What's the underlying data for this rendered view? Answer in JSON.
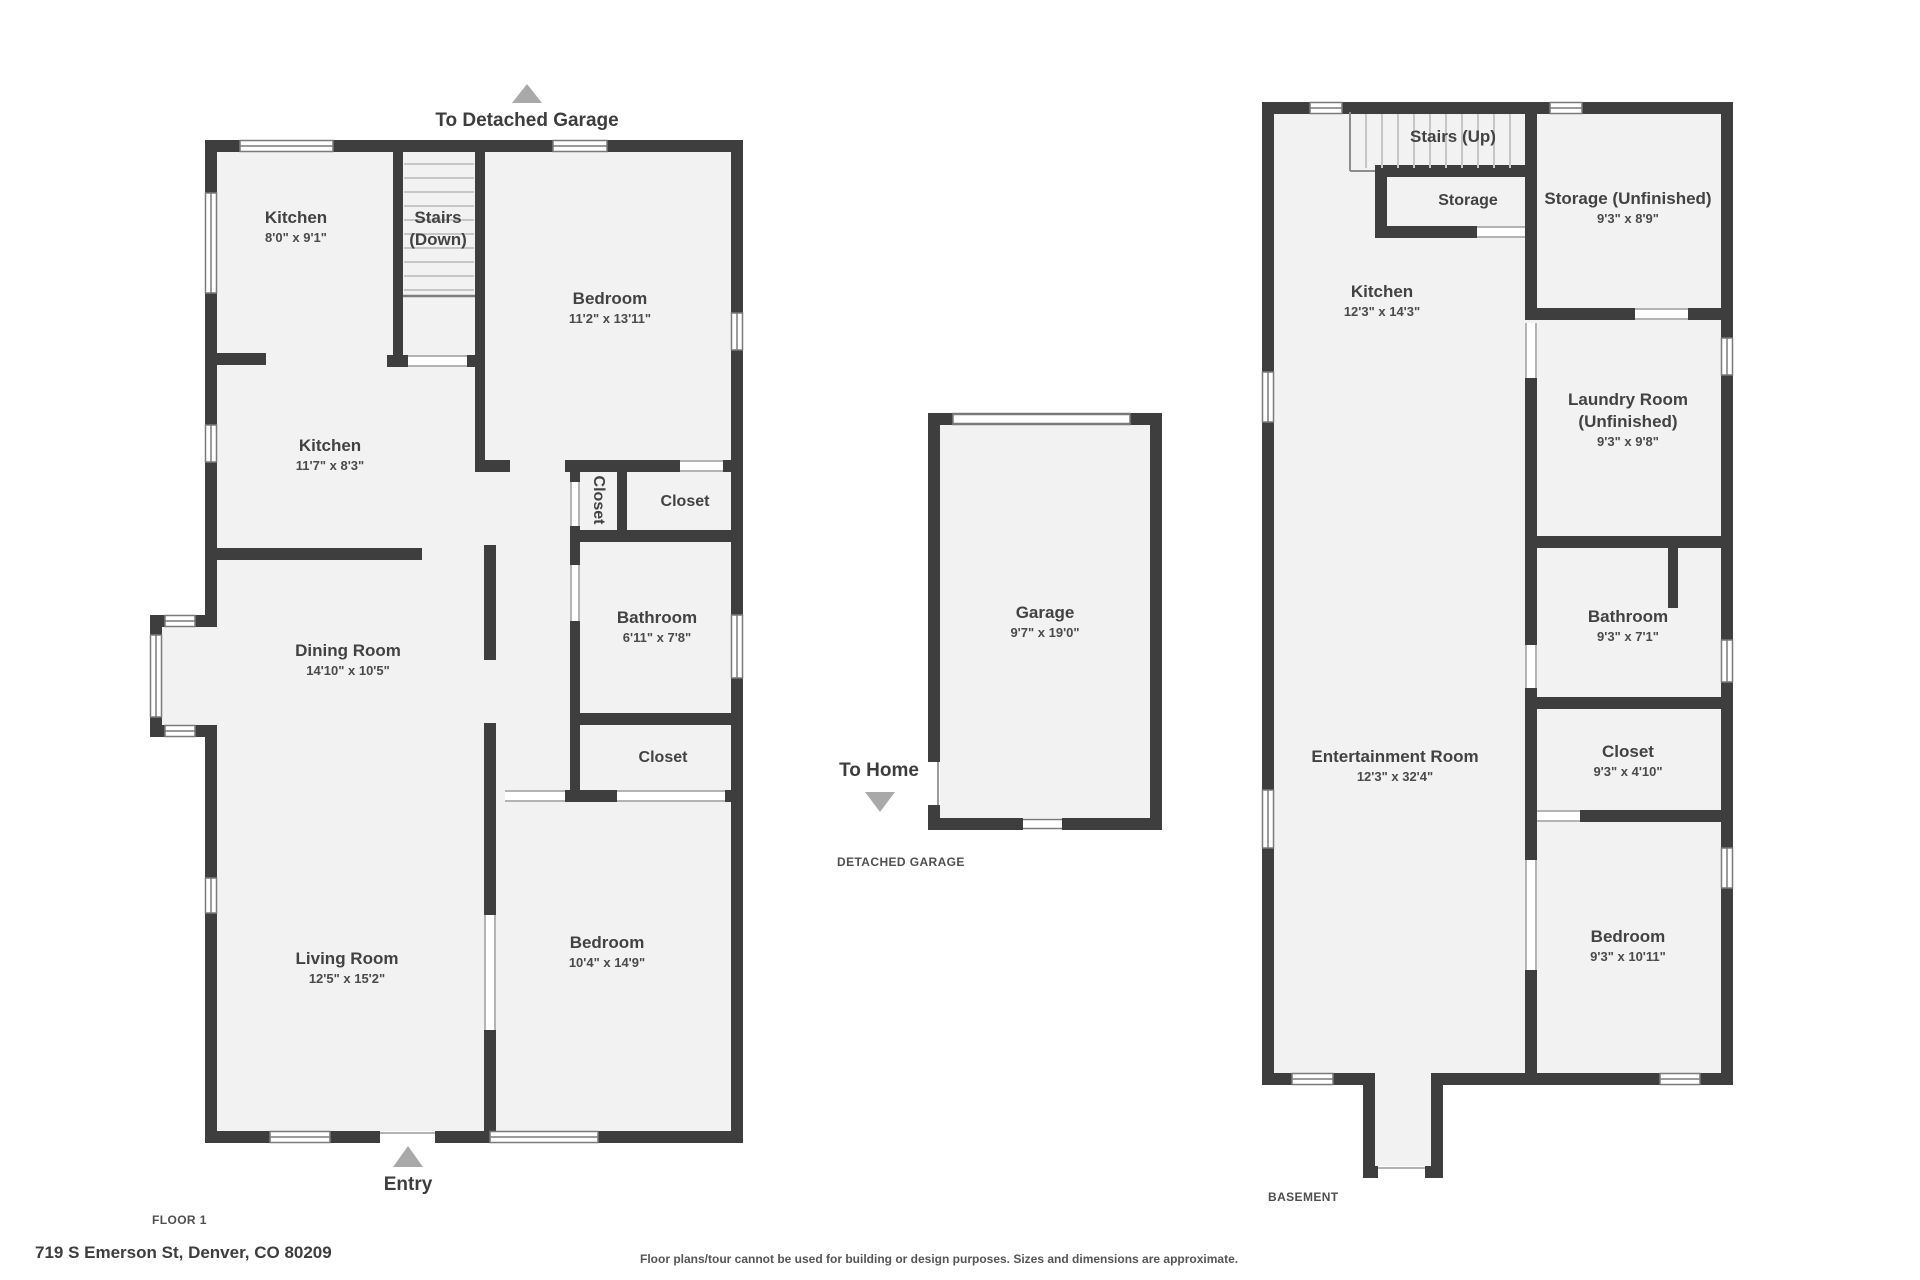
{
  "floor1": {
    "section_label": "FLOOR 1",
    "to_detached_garage_label": "To Detached Garage",
    "entry_label": "Entry",
    "rooms": {
      "kitchen_upper": {
        "name": "Kitchen",
        "dims": "8'0\" x 9'1\""
      },
      "stairs_down": {
        "line1": "Stairs",
        "line2": "(Down)"
      },
      "bedroom_upper": {
        "name": "Bedroom",
        "dims": "11'2\" x 13'11\""
      },
      "kitchen_lower": {
        "name": "Kitchen",
        "dims": "11'7\" x 8'3\""
      },
      "closet_vertical": {
        "name": "Closet"
      },
      "closet_upper": {
        "name": "Closet"
      },
      "bathroom": {
        "name": "Bathroom",
        "dims": "6'11\" x 7'8\""
      },
      "dining_room": {
        "name": "Dining Room",
        "dims": "14'10\" x 10'5\""
      },
      "closet_lower": {
        "name": "Closet"
      },
      "living_room": {
        "name": "Living Room",
        "dims": "12'5\" x 15'2\""
      },
      "bedroom_lower": {
        "name": "Bedroom",
        "dims": "10'4\" x 14'9\""
      }
    }
  },
  "garage": {
    "section_label": "DETACHED GARAGE",
    "to_home_label": "To Home",
    "rooms": {
      "garage": {
        "name": "Garage",
        "dims": "9'7\" x 19'0\""
      }
    }
  },
  "basement": {
    "section_label": "BASEMENT",
    "rooms": {
      "stairs_up": {
        "name": "Stairs (Up)"
      },
      "storage": {
        "name": "Storage"
      },
      "storage_unfinished": {
        "name": "Storage (Unfinished)",
        "dims": "9'3\" x 8'9\""
      },
      "kitchen": {
        "name": "Kitchen",
        "dims": "12'3\" x 14'3\""
      },
      "laundry": {
        "name": "Laundry Room",
        "name2": "(Unfinished)",
        "dims": "9'3\" x 9'8\""
      },
      "bathroom": {
        "name": "Bathroom",
        "dims": "9'3\" x 7'1\""
      },
      "closet": {
        "name": "Closet",
        "dims": "9'3\" x 4'10\""
      },
      "entertainment": {
        "name": "Entertainment Room",
        "dims": "12'3\" x 32'4\""
      },
      "bedroom": {
        "name": "Bedroom",
        "dims": "9'3\" x 10'11\""
      }
    }
  },
  "footer": {
    "address": "719 S Emerson St, Denver, CO 80209",
    "disclaimer": "Floor plans/tour cannot be used for building or design purposes. Sizes and dimensions are approximate."
  },
  "colors": {
    "wall": "#3e3e3e",
    "floor": "#f2f2f2",
    "arrow": "#a9a9a9",
    "window_line": "#7a7a7a"
  }
}
